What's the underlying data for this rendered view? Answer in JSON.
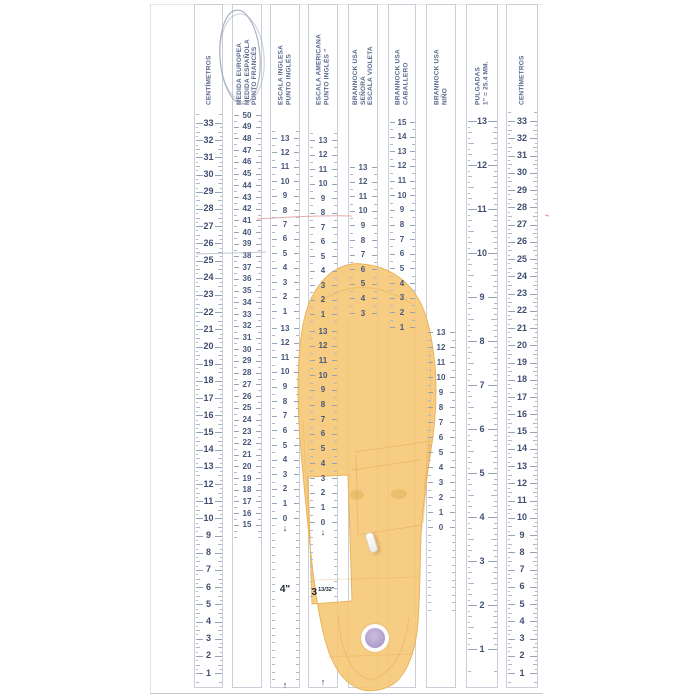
{
  "title": "Tabla de medidas de calzado (plantilla Brannock)",
  "colors": {
    "number_ink": "#46567a",
    "header_ink": "#5a6b90",
    "tick_ink": "#aeb8c9",
    "strip_border": "#c9ced8",
    "insole_fill": "#f6c876",
    "insole_edge": "#e8b45c",
    "sticker_purple": "#b2a0cd",
    "pen_red": "#d98f8f",
    "pen_blue_gray": "#97a1b4"
  },
  "scales": [
    {
      "id": "centimetros-left",
      "header": [
        "CENTÍMETROS"
      ],
      "x": 194,
      "w": 29,
      "style": "cm",
      "big": true,
      "segments": [
        {
          "values": [
            33,
            32,
            31,
            30,
            29,
            28,
            27,
            26,
            25,
            24,
            23,
            22,
            21,
            20,
            19,
            18,
            17,
            16,
            15,
            14,
            13,
            12,
            11,
            10,
            9,
            8,
            7,
            6,
            5,
            4,
            3,
            2,
            1
          ],
          "y0": 123,
          "dy": 17.19,
          "ext_before": 2,
          "ext_after": 2
        }
      ],
      "markers": []
    },
    {
      "id": "medida-europea",
      "header": [
        "MEDIDA EUROPEA",
        "MEDIDA ESPAÑOLA",
        "PUNTO FRANCÉS"
      ],
      "x": 232,
      "w": 30,
      "style": "eu",
      "circled": true,
      "segments": [
        {
          "values": [
            50,
            49,
            48,
            47,
            46,
            45,
            44,
            43,
            42,
            41,
            40,
            39,
            38,
            37,
            36,
            35,
            34,
            33,
            32,
            31,
            30,
            29,
            28,
            27,
            26,
            25,
            24,
            23,
            22,
            21,
            20,
            19,
            18,
            17,
            16,
            15
          ],
          "y0": 115,
          "dy": 11.71,
          "ext_before": 0,
          "ext_after": 2
        }
      ],
      "markers": []
    },
    {
      "id": "escala-inglesa",
      "header": [
        "ESCALA INGLESA",
        "PUNTO INGLÉS"
      ],
      "x": 270,
      "w": 30,
      "style": "size",
      "segments": [
        {
          "values": [
            13,
            12,
            11,
            10,
            9,
            8,
            7,
            6,
            5,
            4,
            3,
            2,
            1
          ],
          "y0": 138,
          "dy": 14.42,
          "ext_before": 1,
          "ext_after": 1
        },
        {
          "values": [
            13,
            12,
            11,
            10,
            9,
            8,
            7,
            6,
            5,
            4,
            3,
            2,
            1,
            0
          ],
          "y0": 328,
          "dy": 14.62,
          "ext_before": 0,
          "ext_after": 30,
          "arrow_below": true
        }
      ],
      "markers": [
        {
          "type": "text",
          "text": "4\"",
          "y": 590
        },
        {
          "type": "arrow-up",
          "y": 684
        }
      ]
    },
    {
      "id": "escala-americana",
      "header": [
        "ESCALA  AMERICANA",
        "PUNTO INGLÉS ”"
      ],
      "x": 308,
      "w": 30,
      "style": "size",
      "segments": [
        {
          "values": [
            13,
            12,
            11,
            10,
            9,
            8,
            7,
            6,
            5,
            4,
            3,
            2,
            1
          ],
          "y0": 140,
          "dy": 14.5,
          "ext_before": 1,
          "ext_after": 1
        },
        {
          "values": [
            13,
            12,
            11,
            10,
            9,
            8,
            7,
            6,
            5,
            4,
            3,
            2,
            1,
            0
          ],
          "y0": 331,
          "dy": 14.7,
          "ext_before": 0,
          "ext_after": 10,
          "arrow_below": true
        }
      ],
      "markers": [
        {
          "type": "fraction",
          "whole": "3",
          "frac": "13/32\"",
          "y": 588
        },
        {
          "type": "arrow-up",
          "y": 681
        }
      ]
    },
    {
      "id": "brannock-usa-senora",
      "header": [
        "BRANNOCK USA",
        "SEÑORA",
        "ESCALA VIOLETA"
      ],
      "x": 348,
      "w": 30,
      "style": "size",
      "segments": [
        {
          "values": [
            13,
            12,
            11,
            10,
            9,
            8,
            7,
            6,
            5,
            4,
            3
          ],
          "y0": 167,
          "dy": 14.6,
          "ext_before": 0,
          "ext_after": 0
        }
      ],
      "markers": []
    },
    {
      "id": "brannock-usa-caballero",
      "header": [
        "BRANNOCK USA",
        "CABALLERO"
      ],
      "x": 388,
      "w": 28,
      "style": "size",
      "segments": [
        {
          "values": [
            15,
            14,
            13,
            12,
            11,
            10,
            9,
            8,
            7,
            6,
            5,
            4,
            3,
            2,
            1
          ],
          "y0": 122,
          "dy": 14.64,
          "ext_before": 0,
          "ext_after": 0
        }
      ],
      "markers": []
    },
    {
      "id": "brannock-usa-nino",
      "header": [
        "BRANNOCK USA",
        "NIÑO"
      ],
      "x": 426,
      "w": 30,
      "style": "size",
      "segments": [
        {
          "values": [
            13,
            12,
            11,
            10,
            9,
            8,
            7,
            6,
            5,
            4,
            3,
            2,
            1,
            0
          ],
          "y0": 332,
          "dy": 15.0,
          "ext_before": 0,
          "ext_after": 11
        }
      ],
      "markers": []
    },
    {
      "id": "pulgadas",
      "header": [
        "PULGADAS",
        "1\" = 25.4 MM."
      ],
      "x": 466,
      "w": 32,
      "style": "inch",
      "big": true,
      "segments": [
        {
          "values": [
            13,
            12,
            11,
            10,
            9,
            8,
            7,
            6,
            5,
            4,
            3,
            2,
            1
          ],
          "y0": 121,
          "dy": 44,
          "ext_before": 3,
          "ext_after": 7
        }
      ],
      "markers": []
    },
    {
      "id": "centimetros-right",
      "header": [
        "CENTÍMETROS"
      ],
      "x": 506,
      "w": 32,
      "style": "cm",
      "big": true,
      "segments": [
        {
          "values": [
            33,
            32,
            31,
            30,
            29,
            28,
            27,
            26,
            25,
            24,
            23,
            22,
            21,
            20,
            19,
            18,
            17,
            16,
            15,
            14,
            13,
            12,
            11,
            10,
            9,
            8,
            7,
            6,
            5,
            4,
            3,
            2,
            1
          ],
          "y0": 121,
          "dy": 17.25,
          "ext_before": 2,
          "ext_after": 2
        }
      ],
      "markers": []
    }
  ],
  "annotations": {
    "circled_scale": "medida-europea",
    "red_line": {
      "x1": 257,
      "y1": 219,
      "x2": 352,
      "y2": 216
    },
    "red_tick": {
      "x": 545,
      "y": 215
    },
    "gray_line": {
      "x1": 196,
      "y1": 254,
      "x2": 266,
      "y2": 252
    }
  },
  "objects": {
    "insole": "plantilla amarilla con ventana de lectura",
    "staple": "grapa blanca",
    "sticker": "etiqueta circular violeta"
  }
}
